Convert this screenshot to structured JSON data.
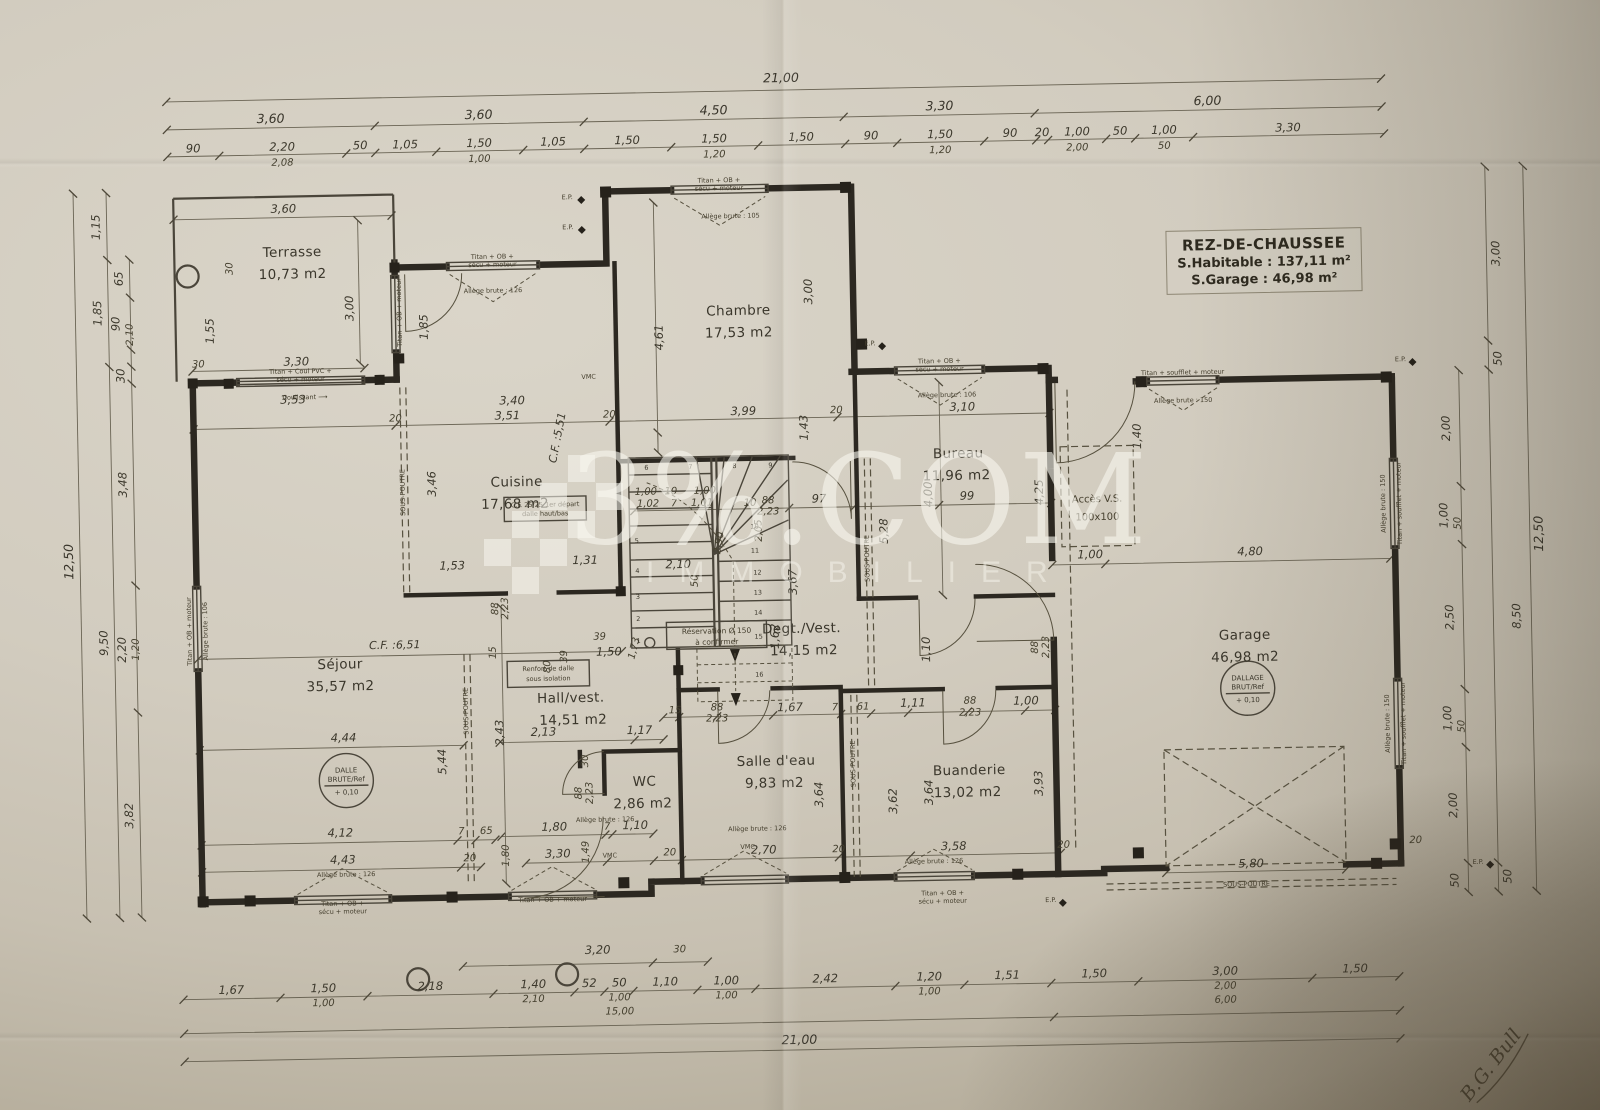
{
  "title_block": {
    "line1": "REZ-DE-CHAUSSEE",
    "line2": "S.Habitable : 137,11 m²",
    "line3": "S.Garage : 46,98 m²"
  },
  "watermark": {
    "brand": "3%.COM",
    "subtitle": "IMMOBILIER"
  },
  "rooms": [
    {
      "name": "Terrasse",
      "area": "10,73 m2"
    },
    {
      "name": "Chambre",
      "area": "17,53 m2"
    },
    {
      "name": "Cuisine",
      "area": "17,68 m2"
    },
    {
      "name": "Séjour",
      "area": "35,57 m2"
    },
    {
      "name": "Hall/vest.",
      "area": "14,51 m2"
    },
    {
      "name": "WC",
      "area": "2,86 m2"
    },
    {
      "name": "Salle d'eau",
      "area": "9,83 m2"
    },
    {
      "name": "Degt./Vest.",
      "area": "14,15 m2"
    },
    {
      "name": "Bureau",
      "area": "11,96 m2"
    },
    {
      "name": "Buanderie",
      "area": "13,02 m2"
    },
    {
      "name": "Garage",
      "area": "46,98 m2"
    }
  ],
  "access_vs": {
    "line1": "Accès V.S.",
    "line2": "100x100"
  },
  "slab": {
    "dalle": [
      "DALLE",
      "BRUTE/Ref",
      "+ 0,10"
    ],
    "dallage": [
      "DALLAGE",
      "BRUT/Ref",
      "+ 0,10"
    ]
  },
  "notes": {
    "renfort1": "Renfort de dalle",
    "renfort2": "sous isolation",
    "reservation1": "Réservation Ø 150",
    "reservation2": "à confirmer",
    "cf25a": "C.F. 25/25 1er départ",
    "cf25b": "dalle haut/bas",
    "coulissant": "Coulissant ⟶",
    "sous_poutre": "SOUS-POUTRE",
    "vmc": "VMC",
    "ep": "E.P."
  },
  "window_labels": {
    "titan_ob2a": "Titan + OB +",
    "titan_ob2b": "sécu + moteur",
    "titan_ob": "Titan + OB + moteur",
    "titan_soufflet": "Titan + soufflet + moteur",
    "titan_coul_a": "Titan + Coul PVC +",
    "titan_coul_b": "sécu + moteur",
    "allege126": "Allège brute : 126",
    "allege105": "Allège brute : 105",
    "allege106": "Allège brute : 106",
    "allege150": "Allège brute : 150"
  },
  "dims": {
    "top1": "21,00",
    "top2": [
      "3,60",
      "3,60",
      "4,50",
      "3,30",
      "6,00"
    ],
    "top3": [
      "90",
      "2,20",
      "50",
      "1,05",
      "1,50",
      "1,05",
      "1,50",
      "1,50",
      "1,50",
      "90",
      "1,50",
      "90",
      "20",
      "1,00",
      "50",
      "1,00",
      "3,30"
    ],
    "top3sub": [
      "2,08",
      "1,00",
      "1,20",
      "1,20",
      "2,00",
      "50"
    ],
    "bottom1": [
      "1,67",
      "1,50",
      "2,18",
      "1,40",
      "52",
      "50",
      "1,10",
      "1,00",
      "2,42",
      "1,20",
      "1,51",
      "1,50",
      "3,00",
      "1,50"
    ],
    "bottom1sub": [
      "1,00",
      "2,10",
      "1,00",
      "1,00",
      "1,00",
      "2,00"
    ],
    "bottom2": [
      "15,00",
      "6,00"
    ],
    "bottom3": "21,00",
    "left": [
      "12,50",
      "1,15",
      "1,85",
      "9,50",
      "65",
      "90",
      "2,10",
      "30",
      "3,48",
      "2,20",
      "1,20",
      "3,82"
    ],
    "right": [
      "12,50",
      "3,00",
      "50",
      "8,50",
      "50",
      "2,00",
      "1,00",
      "50",
      "2,50",
      "1,00",
      "50",
      "2,00",
      "50"
    ],
    "interior": [
      "3,53",
      "3,40",
      "3,51",
      "20",
      "20",
      "3,99",
      "20",
      "3,10",
      "3,46",
      "C.F. :5,51",
      "4,61",
      "3,00",
      "1,53",
      "1,31",
      "1,40",
      "1,00",
      "4,80",
      "4,00",
      "99",
      "5,28",
      "4,25",
      "1,43",
      "97",
      "88",
      "2,23",
      "10",
      "1,00",
      "10",
      "1,00",
      "1,02",
      "7",
      "1,01",
      "2,05",
      "2,90",
      "2,10",
      "50",
      "1,62",
      "3,67",
      "C.F. :6,51",
      "4,44",
      "5,44",
      "2,43",
      "4,12",
      "4,43",
      "7",
      "65",
      "20",
      "1,80",
      "2,13",
      "1,17",
      "30",
      "88",
      "2,23",
      "1,80",
      "7",
      "1,10",
      "3,30",
      "1,49",
      "20",
      "2,70",
      "15",
      "88",
      "2,23",
      "1,67",
      "39",
      "1,50",
      "1,73",
      "3,64",
      "3,62",
      "3,64",
      "3,93",
      "3,58",
      "20",
      "20",
      "7",
      "61",
      "1,11",
      "88",
      "2,23",
      "1,00",
      "1,10",
      "88",
      "2,23",
      "5,80",
      "20",
      "3,20",
      "30",
      "1,55",
      "3,60",
      "3,30",
      "3,00",
      "30",
      "30",
      "1,85",
      "15",
      "80",
      "39",
      "88",
      "2,23"
    ]
  },
  "stairs": {
    "numbers": [
      "1",
      "2",
      "3",
      "4",
      "5",
      "6",
      "7",
      "8",
      "9",
      "10",
      "11",
      "12",
      "13",
      "14",
      "15",
      "16"
    ]
  },
  "signature": "B.G. Bull"
}
